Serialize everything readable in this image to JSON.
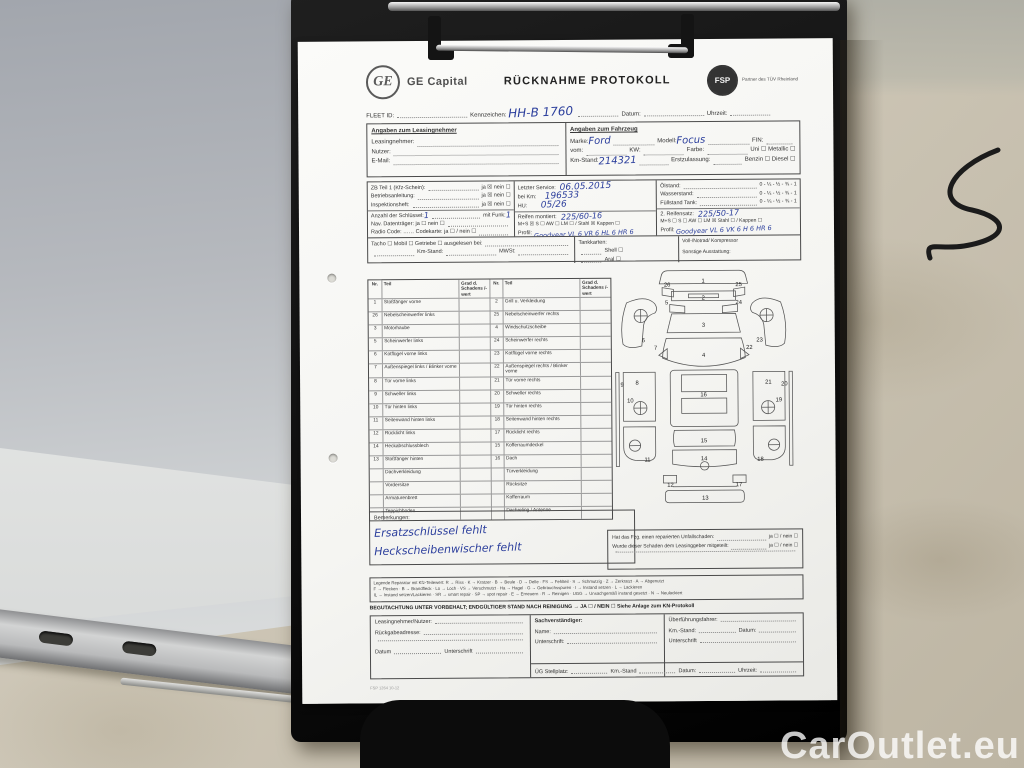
{
  "watermark": "CarOutlet.eu",
  "doc": {
    "header": {
      "logo_monogram": "GE",
      "brand": "GE Capital",
      "title": "RÜCKNAHME PROTOKOLL",
      "partner_badge": "FSP",
      "partner_text": "Partner des TÜV Rheinland"
    },
    "topline": {
      "fleet": "FLEET ID:",
      "plate": "Kennzeichen:",
      "plate_value": "HH-B 1760",
      "date": "Datum:",
      "time": "Uhrzeit:"
    },
    "lessee": {
      "heading": "Angaben zum Leasingnehmer",
      "rows": [
        "Leasingnehmer:",
        "Nutzer:",
        "E-Mail:"
      ]
    },
    "vehicle": {
      "heading": "Angaben zum Fahrzeug",
      "marke": "Marke:",
      "marke_value": "Ford",
      "modell": "Modell:",
      "modell_value": "Focus",
      "fin": "FIN:",
      "vom": "vom:",
      "kw": "KW:",
      "farbe": "Farbe:",
      "uni": "Uni ☐",
      "metallic": "Metallic ☐",
      "km": "Km-Stand:",
      "km_value": "214321",
      "ez": "Erstzulassung:",
      "benzin": "Benzin ☐",
      "diesel": "Diesel ☐"
    },
    "docs_col": {
      "rows": [
        {
          "l": "ZB Teil 1 (Kfz-Schein):",
          "r": "ja ☒  nein ☐"
        },
        {
          "l": "Betriebsanleitung:",
          "r": "ja ☒  nein ☐"
        },
        {
          "l": "Inspektionsheft:",
          "r": "ja ☒  nein ☐"
        }
      ],
      "keys": "Anzahl der Schlüssel:",
      "keys_value": "1",
      "funk": "mit Funk:",
      "funk_value": "1",
      "nav": "Nav. Datenträger:  ja ☐  nein ☐",
      "radio": "Radio Code: ……  Codekarte: ja ☐ / nein ☐"
    },
    "service_col": {
      "service": "Letzter Service:",
      "service_value": "06.05.2015",
      "beikm": "bei Km:",
      "beikm_value": "196533",
      "hu": "HU:",
      "hu_value": "05/26",
      "tyres": "Reifen montiert:",
      "tyres_value": "225/60-16",
      "tyres_opts": "M+S ☒  S ☐  AW ☐    LM ☐ / Stahl ☒  Kappen ☐",
      "profil": "Profil:",
      "profil_value": "Goodyear VL 6 VR 6 HL 6 HR 6"
    },
    "levels_col": {
      "oel": "Ölstand:",
      "wasser": "Wasserstand:",
      "tank": "Füllstand Tank:",
      "scale": "0 - ¼ - ½ - ¾ - 1",
      "set2": "2. Reifensatz:",
      "set2_value": "225/50-17",
      "set2_opts": "M+S ☐  S ☐  AW ☐    LM ☒  Stahl ☐ / Kappen ☐",
      "profil": "Profil:",
      "profil_value": "Goodyear VL 6 VK 6 H 6 HR 6"
    },
    "presence": {
      "line1": "Tacho ☐   Mobil ☐   Getriebe ☐   ausgelesen bei:",
      "km": "Km-Stand:",
      "mwst": "MWSt:",
      "tank_heading": "Tankkarten:",
      "tank_items": [
        "Shell  ☐",
        "Aral  ☐",
        "Total  ☐"
      ],
      "spare": "Voll-/Notrad/ Kompressor",
      "extra": "Sonstige Ausstattung:"
    },
    "damage": {
      "headers": [
        "Nr.",
        "Teil",
        "Grad d. Schadens /-wert",
        "Nr.",
        "Teil",
        "Grad d. Schadens /-wert"
      ],
      "rows": [
        {
          "ln": "1",
          "lp": "Stoßfänger vorne",
          "rn": "2",
          "rp": "Grill u. Verkleidung"
        },
        {
          "ln": "26",
          "lp": "Nebelscheinwerfer links",
          "rn": "25",
          "rp": "Nebelscheinwerfer rechts"
        },
        {
          "ln": "3",
          "lp": "Motorhaube",
          "rn": "4",
          "rp": "Windschutzscheibe"
        },
        {
          "ln": "5",
          "lp": "Scheinwerfer links",
          "rn": "24",
          "rp": "Scheinwerfer rechts"
        },
        {
          "ln": "6",
          "lp": "Kotflügel vorne links",
          "rn": "23",
          "rp": "Kotflügel vorne rechts"
        },
        {
          "ln": "7",
          "lp": "Außenspiegel links / Blinker vorne",
          "rn": "22",
          "rp": "Außenspiegel rechts / Blinker vorne"
        },
        {
          "ln": "8",
          "lp": "Tür vorne links",
          "rn": "21",
          "rp": "Tür vorne rechts"
        },
        {
          "ln": "9",
          "lp": "Schweller links",
          "rn": "20",
          "rp": "Schweller rechts"
        },
        {
          "ln": "10",
          "lp": "Tür hinten links",
          "rn": "19",
          "rp": "Tür hinten rechts"
        },
        {
          "ln": "11",
          "lp": "Seitenwand hinten links",
          "rn": "18",
          "rp": "Seitenwand hinten rechts"
        },
        {
          "ln": "12",
          "lp": "Rücklicht links",
          "rn": "17",
          "rp": "Rücklicht rechts"
        },
        {
          "ln": "14",
          "lp": "Heckabschlussblech",
          "rn": "15",
          "rp": "Kofferraumdeckel"
        },
        {
          "ln": "13",
          "lp": "Stoßfänger hinten",
          "rn": "16",
          "rp": "Dach"
        },
        {
          "ln": "",
          "lp": "Dachverkleidung",
          "rn": "",
          "rp": "Türverkleidung"
        },
        {
          "ln": "",
          "lp": "Vordersitze",
          "rn": "",
          "rp": "Rücksitze"
        },
        {
          "ln": "",
          "lp": "Armaturenbrett",
          "rn": "",
          "rp": "Kofferraum"
        },
        {
          "ln": "",
          "lp": "Teppichboden",
          "rn": "",
          "rp": "Dachreling / Antenne"
        }
      ],
      "remarks_label": "Bemerkungen:",
      "remarks": [
        "Ersatzschlüssel fehlt",
        "Heckscheibenwischer fehlt"
      ]
    },
    "diagram": {
      "labels": [
        "1",
        "26",
        "25",
        "2",
        "5",
        "24",
        "3",
        "6",
        "23",
        "7",
        "22",
        "4",
        "8",
        "21",
        "9",
        "20",
        "10",
        "19",
        "16",
        "15",
        "11",
        "18",
        "14",
        "12",
        "17",
        "13"
      ]
    },
    "accident": {
      "q1": "Hat das Fzg. einen reparierten Unfallschaden:",
      "a1": "ja ☐ / nein ☐",
      "q2": "Wurde dieser Schaden dem Leasinggeber mitgeteilt:",
      "a2": "ja ☐ / nein ☐"
    },
    "legend": {
      "lines": [
        "Legende Reparatur mit Kfz-Teilewert:  R → Riss · K → Kratzer · B → Beule · D → Delle · FS → Fehlteil · S → Schmutzig · Z → Zerkratzt · A → Abgenutzt",
        "F → Flecken · B → Brandfleck · Lo → Loch · VS → Verschmutzt · Ha → Hagel · G → Gebrauchsspuren · I → Instand setzen · L → Lackieren",
        "IL → Instand setzen/Lackieren · SR → smart repair · SP → spot repair · E → Erneuern · R → Reinigen · UGG → Unsachgemäß instand gesetzt · N → Neulackiert"
      ]
    },
    "appraisal": "BEGUTACHTUNG UNTER VORBEHALT; ENDGÜLTIGER STAND NACH REINIGUNG → JA ☐ / NEIN ☐   Siehe Anlage zum KN-Protokoll",
    "signature": {
      "c1r1": "Leasingnehmer/Nutzer:",
      "c1r2": "Rückgabeadresse:",
      "c1r4a": "Datum",
      "c1r4b": "Unterschrift",
      "c2h": "Sachverständiger:",
      "c2r1": "Name:",
      "c2r2": "Unterschrift:",
      "c3r1": "Überführungsfahrer:",
      "c3r2a": "Km.-Stand:",
      "c3r2b": "Datum:",
      "c3r3": "Unterschrift",
      "b1": "ÜG Stellplatz:",
      "b2": "Km.-Stand",
      "b3": "Datum:",
      "b4": "Uhrzeit:"
    },
    "form_code": "FSP 1264 10-12"
  }
}
